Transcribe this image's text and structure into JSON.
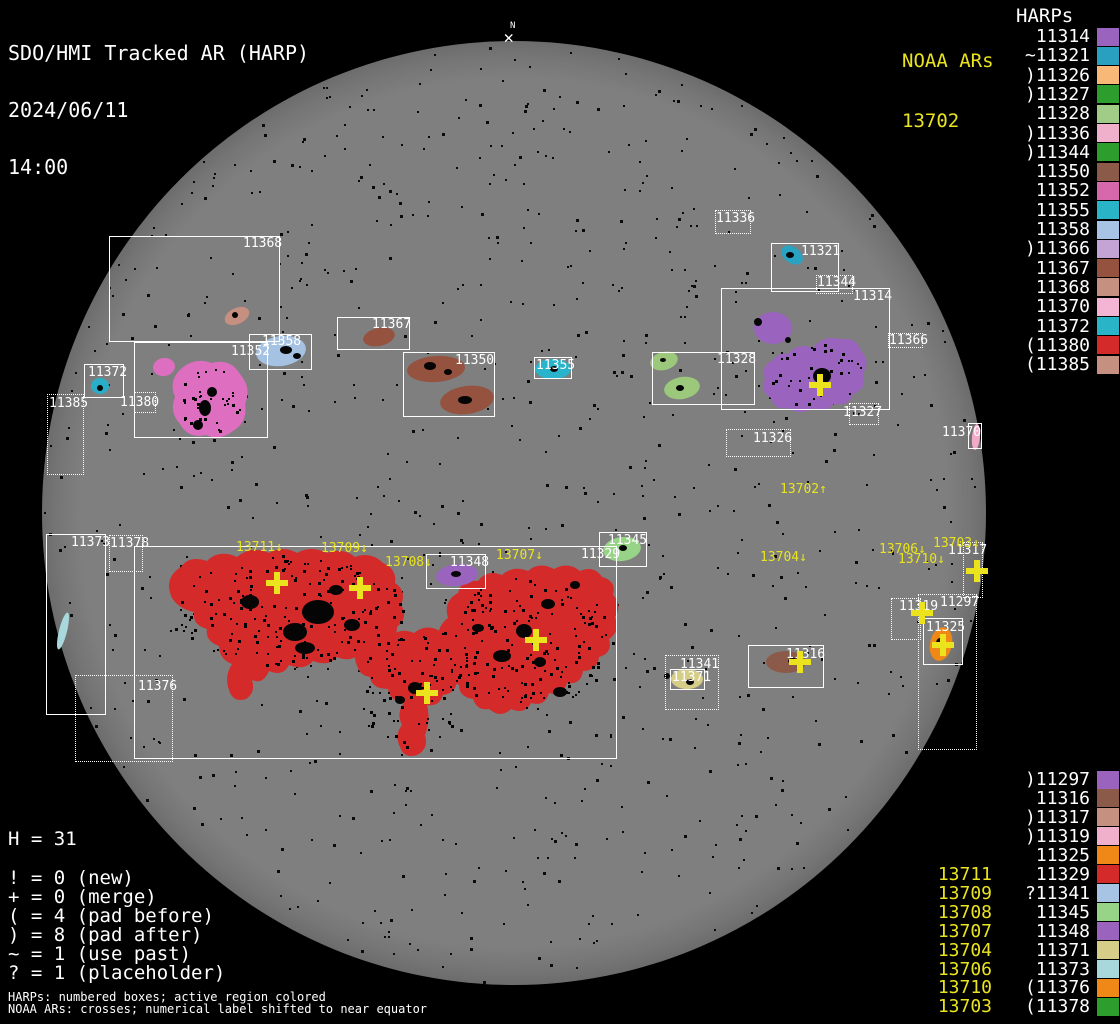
{
  "header": {
    "title": "SDO/HMI Tracked AR (HARP)",
    "date": "2024/06/11",
    "time": "14:00"
  },
  "noaa_panel": {
    "header": "NOAA ARs",
    "value": "13702"
  },
  "north_marker": {
    "label": "N",
    "glyph": "✕"
  },
  "stats": {
    "h_line": "H = 31",
    "legend": [
      "! = 0 (new)",
      "+ = 0 (merge)",
      "( = 4 (pad before)",
      ") = 8 (pad after)",
      "~ = 1 (use past)",
      "? = 1 (placeholder)"
    ]
  },
  "footer": {
    "line1": "HARPs: numbered boxes; active region colored",
    "line2": "NOAA ARs: crosses; numerical label shifted to near equator"
  },
  "colors": {
    "accent_yellow": "#e9e41f",
    "box_white": "#ffffff",
    "red": "#d42a2a",
    "disk_gray": "#7e7e7e"
  },
  "harps_panel": {
    "header": "HARPs",
    "top_list": [
      {
        "text": "11314",
        "color": "#9a63bd"
      },
      {
        "text": "~11321",
        "color": "#29a0c0"
      },
      {
        "text": ")11326",
        "color": "#f8b878"
      },
      {
        "text": ")11327",
        "color": "#2d9e2d"
      },
      {
        "text": "11328",
        "color": "#a0cc88"
      },
      {
        "text": ")11336",
        "color": "#f0b0cc"
      },
      {
        "text": ")11344",
        "color": "#2d9e2d"
      },
      {
        "text": "11350",
        "color": "#8b5a49"
      },
      {
        "text": "11352",
        "color": "#d868ac"
      },
      {
        "text": "11355",
        "color": "#29b4c8"
      },
      {
        "text": "11358",
        "color": "#a8c4e4"
      },
      {
        "text": ")11366",
        "color": "#c4a4d4"
      },
      {
        "text": "11367",
        "color": "#94523f"
      },
      {
        "text": "11368",
        "color": "#c69080"
      },
      {
        "text": "11370",
        "color": "#f4b4d4"
      },
      {
        "text": "11372",
        "color": "#29b4c8"
      },
      {
        "text": "(11380",
        "color": "#d42a2a"
      },
      {
        "text": "(11385",
        "color": "#c69080"
      }
    ],
    "bottom_list": [
      {
        "noaa": "",
        "text": ")11297",
        "color": "#9a63bd"
      },
      {
        "noaa": "",
        "text": "11316",
        "color": "#8b5a49"
      },
      {
        "noaa": "",
        "text": ")11317",
        "color": "#c69080"
      },
      {
        "noaa": "",
        "text": ")11319",
        "color": "#f0b0cc"
      },
      {
        "noaa": "",
        "text": "11325",
        "color": "#f08818"
      },
      {
        "noaa": "13711",
        "text": "11329",
        "color": "#d42a2a"
      },
      {
        "noaa": "13709",
        "text": "?11341",
        "color": "#a8c4e4"
      },
      {
        "noaa": "13708",
        "text": "11345",
        "color": "#98d488"
      },
      {
        "noaa": "13707",
        "text": "11348",
        "color": "#9a63bd"
      },
      {
        "noaa": "13704",
        "text": "11371",
        "color": "#d6ce88"
      },
      {
        "noaa": "13706",
        "text": "11373",
        "color": "#a8d8dc"
      },
      {
        "noaa": "13710",
        "text": "(11376",
        "color": "#f08818"
      },
      {
        "noaa": "13703",
        "text": "(11378",
        "color": "#2d9e2d"
      }
    ]
  },
  "harp_boxes": [
    {
      "label": "11368",
      "x": 109,
      "y": 236,
      "w": 171,
      "h": 106,
      "style": "solid",
      "lx": 243,
      "ly": 237
    },
    {
      "label": "11352",
      "x": 134,
      "y": 342,
      "w": 134,
      "h": 96,
      "style": "solid",
      "lx": 231,
      "ly": 345
    },
    {
      "label": "11358",
      "x": 249,
      "y": 334,
      "w": 63,
      "h": 36,
      "style": "solid",
      "lx": 262,
      "ly": 335
    },
    {
      "label": "11372",
      "x": 84,
      "y": 364,
      "w": 40,
      "h": 34,
      "style": "solid",
      "lx": 88,
      "ly": 366
    },
    {
      "label": "11367",
      "x": 337,
      "y": 317,
      "w": 73,
      "h": 33,
      "style": "solid",
      "lx": 372,
      "ly": 318
    },
    {
      "label": "11350",
      "x": 403,
      "y": 352,
      "w": 92,
      "h": 65,
      "style": "solid",
      "lx": 455,
      "ly": 354
    },
    {
      "label": "11355",
      "x": 534,
      "y": 357,
      "w": 38,
      "h": 22,
      "style": "solid",
      "lx": 536,
      "ly": 359
    },
    {
      "label": "11321",
      "x": 771,
      "y": 243,
      "w": 68,
      "h": 49,
      "style": "solid",
      "lx": 801,
      "ly": 245
    },
    {
      "label": "11314",
      "x": 721,
      "y": 288,
      "w": 169,
      "h": 122,
      "style": "solid",
      "lx": 853,
      "ly": 290
    },
    {
      "label": "11328",
      "x": 652,
      "y": 352,
      "w": 103,
      "h": 53,
      "style": "solid",
      "lx": 717,
      "ly": 353
    },
    {
      "label": "11373",
      "x": 46,
      "y": 534,
      "w": 60,
      "h": 181,
      "style": "solid",
      "lx": 71,
      "ly": 536
    },
    {
      "label": "11329",
      "x": 134,
      "y": 546,
      "w": 483,
      "h": 213,
      "style": "solid",
      "lx": 581,
      "ly": 548
    },
    {
      "label": "11348",
      "x": 426,
      "y": 554,
      "w": 60,
      "h": 35,
      "style": "solid",
      "lx": 450,
      "ly": 556
    },
    {
      "label": "11345",
      "x": 599,
      "y": 532,
      "w": 48,
      "h": 35,
      "style": "solid",
      "lx": 608,
      "ly": 534
    },
    {
      "label": "11371",
      "x": 670,
      "y": 669,
      "w": 35,
      "h": 21,
      "style": "solid",
      "lx": 672,
      "ly": 671
    },
    {
      "label": "11316",
      "x": 748,
      "y": 645,
      "w": 76,
      "h": 43,
      "style": "solid",
      "lx": 786,
      "ly": 648
    },
    {
      "label": "11325",
      "x": 923,
      "y": 618,
      "w": 40,
      "h": 47,
      "style": "solid",
      "lx": 926,
      "ly": 621
    },
    {
      "label": "11370",
      "x": 968,
      "y": 423,
      "w": 14,
      "h": 26,
      "style": "solid",
      "lx": 942,
      "ly": 426
    },
    {
      "label": "11336",
      "x": 715,
      "y": 210,
      "w": 36,
      "h": 24,
      "style": "dotted",
      "lx": 716,
      "ly": 212
    },
    {
      "label": "11344",
      "x": 816,
      "y": 275,
      "w": 37,
      "h": 19,
      "style": "dotted",
      "lx": 817,
      "ly": 276
    },
    {
      "label": "11366",
      "x": 888,
      "y": 333,
      "w": 35,
      "h": 15,
      "style": "dotted",
      "lx": 889,
      "ly": 334
    },
    {
      "label": "11327",
      "x": 849,
      "y": 403,
      "w": 30,
      "h": 22,
      "style": "dotted",
      "lx": 843,
      "ly": 406
    },
    {
      "label": "11326",
      "x": 726,
      "y": 429,
      "w": 65,
      "h": 28,
      "style": "dotted",
      "lx": 753,
      "ly": 432
    },
    {
      "label": "11385",
      "x": 47,
      "y": 394,
      "w": 37,
      "h": 81,
      "style": "dotted",
      "lx": 49,
      "ly": 397
    },
    {
      "label": "11380",
      "x": 134,
      "y": 392,
      "w": 22,
      "h": 21,
      "style": "dotted",
      "lx": 120,
      "ly": 396
    },
    {
      "label": "11378",
      "x": 109,
      "y": 535,
      "w": 34,
      "h": 37,
      "style": "dotted",
      "lx": 110,
      "ly": 537
    },
    {
      "label": "11376",
      "x": 75,
      "y": 675,
      "w": 98,
      "h": 87,
      "style": "dotted",
      "lx": 138,
      "ly": 680
    },
    {
      "label": "11341",
      "x": 665,
      "y": 655,
      "w": 54,
      "h": 55,
      "style": "dotted",
      "lx": 680,
      "ly": 658
    },
    {
      "label": "11317",
      "x": 963,
      "y": 542,
      "w": 20,
      "h": 56,
      "style": "dotted",
      "lx": 948,
      "ly": 544
    },
    {
      "label": "11319",
      "x": 891,
      "y": 598,
      "w": 30,
      "h": 42,
      "style": "dotted",
      "lx": 899,
      "ly": 600
    },
    {
      "label": "11297",
      "x": 918,
      "y": 594,
      "w": 59,
      "h": 156,
      "style": "dotted",
      "lx": 940,
      "ly": 596
    }
  ],
  "noaa_labels": [
    {
      "text": "13711↓",
      "x": 236,
      "y": 541
    },
    {
      "text": "13709↓",
      "x": 321,
      "y": 542
    },
    {
      "text": "13708↓",
      "x": 385,
      "y": 556
    },
    {
      "text": "13707↓",
      "x": 496,
      "y": 549
    },
    {
      "text": "13702↑",
      "x": 780,
      "y": 483
    },
    {
      "text": "13704↓",
      "x": 760,
      "y": 551
    },
    {
      "text": "13706↓",
      "x": 879,
      "y": 543
    },
    {
      "text": "13710↓",
      "x": 898,
      "y": 553
    },
    {
      "text": "13703↓",
      "x": 933,
      "y": 537
    }
  ],
  "crosses": [
    {
      "x": 820,
      "y": 385
    },
    {
      "x": 277,
      "y": 583
    },
    {
      "x": 360,
      "y": 588
    },
    {
      "x": 536,
      "y": 640
    },
    {
      "x": 427,
      "y": 693
    },
    {
      "x": 800,
      "y": 662
    },
    {
      "x": 922,
      "y": 613
    },
    {
      "x": 977,
      "y": 571
    },
    {
      "x": 943,
      "y": 645
    }
  ],
  "disk": {
    "cx": 514,
    "cy": 513,
    "r": 472,
    "blobs": [
      {
        "cx": 100,
        "cy": 386,
        "rx": 9,
        "ry": 8,
        "rot": 0,
        "color": "#2aaec8"
      },
      {
        "cx": 164,
        "cy": 367,
        "rx": 11,
        "ry": 9,
        "rot": -10,
        "color": "#dd6ec0"
      },
      {
        "cx": 237,
        "cy": 316,
        "rx": 13,
        "ry": 8,
        "rot": -25,
        "color": "#c69080"
      },
      {
        "cx": 281,
        "cy": 351,
        "rx": 25,
        "ry": 15,
        "rot": -8,
        "color": "#a6c2e2"
      },
      {
        "cx": 379,
        "cy": 337,
        "rx": 16,
        "ry": 9,
        "rot": -12,
        "color": "#94523f"
      },
      {
        "cx": 436,
        "cy": 369,
        "rx": 29,
        "ry": 13,
        "rot": -4,
        "color": "#94523f"
      },
      {
        "cx": 467,
        "cy": 400,
        "rx": 27,
        "ry": 14,
        "rot": -8,
        "color": "#94523f"
      },
      {
        "cx": 553,
        "cy": 369,
        "rx": 18,
        "ry": 10,
        "rot": 0,
        "color": "#2ab4cc"
      },
      {
        "cx": 792,
        "cy": 255,
        "rx": 12,
        "ry": 8,
        "rot": 35,
        "color": "#2aa2c2"
      },
      {
        "cx": 773,
        "cy": 328,
        "rx": 19,
        "ry": 16,
        "rot": 0,
        "color": "#9a63bd"
      },
      {
        "cx": 664,
        "cy": 361,
        "rx": 14,
        "ry": 9,
        "rot": -15,
        "color": "#9cc87c"
      },
      {
        "cx": 682,
        "cy": 388,
        "rx": 18,
        "ry": 11,
        "rot": -10,
        "color": "#9cc87c"
      },
      {
        "cx": 622,
        "cy": 549,
        "rx": 19,
        "ry": 12,
        "rot": -8,
        "color": "#98d488"
      },
      {
        "cx": 457,
        "cy": 575,
        "rx": 21,
        "ry": 11,
        "rot": -6,
        "color": "#9a63bd"
      },
      {
        "cx": 687,
        "cy": 679,
        "rx": 16,
        "ry": 10,
        "rot": 0,
        "color": "#d6ce88"
      },
      {
        "cx": 786,
        "cy": 662,
        "rx": 20,
        "ry": 11,
        "rot": 0,
        "color": "#8b5a49"
      },
      {
        "cx": 941,
        "cy": 644,
        "rx": 11,
        "ry": 17,
        "rot": 12,
        "color": "#f08818"
      },
      {
        "cx": 976,
        "cy": 437,
        "rx": 4,
        "ry": 13,
        "rot": 5,
        "color": "#f2aac8"
      },
      {
        "cx": 63,
        "cy": 631,
        "rx": 4,
        "ry": 19,
        "rot": 14,
        "color": "#a8d8dc"
      }
    ],
    "paths": [
      {
        "d": "M 178,372 Q 192,356 212,363 Q 230,358 240,374 Q 252,388 245,404 Q 248,422 233,431 Q 221,441 206,435 Q 188,439 180,424 Q 169,412 175,397 Q 169,383 178,372 Z",
        "color": "#dd6ec0"
      },
      {
        "d": "M 788,354 Q 798,342 813,348 Q 823,335 840,339 Q 857,337 861,351 Q 871,361 863,373 Q 868,389 853,394 Q 849,407 834,404 Q 826,413 813,408 Q 800,416 789,408 Q 775,411 771,398 Q 760,392 765,379 Q 761,365 772,361 Q 779,352 788,354 Z",
        "color": "#9a63bd"
      },
      {
        "d": "M 172,598 Q 163,578 181,567 Q 189,555 207,561 Q 219,549 237,557 Q 251,545 269,553 Q 283,545 297,553 Q 311,545 327,553 Q 343,547 355,557 Q 371,551 383,563 Q 397,569 395,583 Q 407,591 401,605 Q 409,617 397,627 Q 397,641 383,645 Q 377,657 361,653 Q 351,663 337,657 Q 329,667 313,661 Q 305,671 289,665 Q 283,677 269,671 Q 263,685 252,680 Q 256,692 246,699 Q 233,703 229,690 Q 224,676 232,664 Q 219,659 219,646 Q 205,641 207,629 Q 192,625 194,612 Q 179,609 172,598 Z",
        "color": "#d42a2a"
      },
      {
        "d": "M 358,668 Q 350,652 364,644 Q 374,631 390,637 Q 400,627 414,633 Q 426,623 440,631 Q 453,625 461,637 Q 471,645 463,657 Q 469,671 457,679 Q 457,693 443,695 Q 439,707 427,705 Q 431,721 425,735 Q 429,749 417,755 Q 404,759 400,747 Q 394,735 402,725 Q 396,713 404,703 Q 390,701 388,689 Q 372,689 370,677 Q 360,675 358,668 Z",
        "color": "#d42a2a"
      },
      {
        "d": "M 442,648 Q 433,629 448,618 Q 443,601 458,593 Q 461,579 478,581 Q 487,569 502,575 Q 513,565 528,571 Q 539,561 554,569 Q 568,561 580,571 Q 594,565 602,577 Q 617,581 613,595 Q 623,605 615,617 Q 621,631 609,639 Q 613,653 599,657 Q 597,671 583,671 Q 581,685 567,683 Q 563,697 549,693 Q 545,707 531,703 Q 525,715 511,709 Q 501,719 489,709 Q 477,711 473,699 Q 459,697 459,685 Q 447,681 449,667 Q 435,661 442,648 Z",
        "color": "#d42a2a"
      }
    ],
    "spots": [
      [
        318,
        612,
        16,
        12
      ],
      [
        295,
        632,
        12,
        9
      ],
      [
        250,
        602,
        9,
        7
      ],
      [
        336,
        590,
        7,
        5
      ],
      [
        305,
        648,
        10,
        6
      ],
      [
        352,
        625,
        8,
        6
      ],
      [
        415,
        688,
        7,
        6
      ],
      [
        400,
        700,
        5,
        4
      ],
      [
        524,
        631,
        8,
        7
      ],
      [
        548,
        604,
        7,
        5
      ],
      [
        502,
        656,
        9,
        6
      ],
      [
        540,
        662,
        6,
        5
      ],
      [
        560,
        692,
        7,
        5
      ],
      [
        478,
        628,
        6,
        4
      ],
      [
        575,
        585,
        5,
        4
      ],
      [
        822,
        376,
        9,
        8
      ],
      [
        758,
        322,
        4,
        4
      ],
      [
        788,
        340,
        3,
        3
      ],
      [
        205,
        408,
        6,
        8
      ],
      [
        212,
        392,
        5,
        5
      ],
      [
        198,
        425,
        5,
        5
      ],
      [
        430,
        366,
        6,
        4
      ],
      [
        465,
        400,
        7,
        4
      ],
      [
        448,
        372,
        4,
        3
      ],
      [
        286,
        350,
        6,
        4
      ],
      [
        297,
        356,
        4,
        3
      ],
      [
        235,
        315,
        3,
        3
      ],
      [
        790,
        255,
        4,
        3
      ],
      [
        667,
        676,
        3,
        3
      ],
      [
        690,
        682,
        4,
        3
      ],
      [
        793,
        661,
        5,
        3
      ],
      [
        940,
        643,
        4,
        5
      ],
      [
        623,
        548,
        4,
        3
      ],
      [
        456,
        574,
        5,
        3
      ],
      [
        100,
        388,
        3,
        3
      ],
      [
        554,
        369,
        4,
        3
      ],
      [
        680,
        388,
        4,
        3
      ],
      [
        663,
        360,
        3,
        2
      ]
    ],
    "texture_regions": [
      {
        "x": 170,
        "y": 552,
        "w": 238,
        "h": 118,
        "n": 280
      },
      {
        "x": 356,
        "y": 632,
        "w": 108,
        "h": 120,
        "n": 110
      },
      {
        "x": 438,
        "y": 572,
        "w": 178,
        "h": 140,
        "n": 230
      },
      {
        "x": 176,
        "y": 366,
        "w": 68,
        "h": 68,
        "n": 45
      },
      {
        "x": 764,
        "y": 340,
        "w": 100,
        "h": 70,
        "n": 40
      }
    ]
  },
  "chart_data": {
    "type": "scatter",
    "title": "SDO/HMI Tracked AR (HARP) — 2024/06/11 14:00",
    "harp_count": 31,
    "noaa_ars_on_disk": [
      "13702",
      "13703",
      "13704",
      "13706",
      "13707",
      "13708",
      "13709",
      "13710",
      "13711"
    ],
    "harps_on_disk": [
      "11368",
      "11352",
      "11358",
      "11372",
      "11367",
      "11350",
      "11355",
      "11321",
      "11314",
      "11328",
      "11373",
      "11329",
      "11348",
      "11345",
      "11371",
      "11316",
      "11325",
      "11370",
      "11336",
      "11344",
      "11366",
      "11327",
      "11326",
      "11385",
      "11380",
      "11378",
      "11376",
      "11341",
      "11317",
      "11319",
      "11297"
    ]
  }
}
